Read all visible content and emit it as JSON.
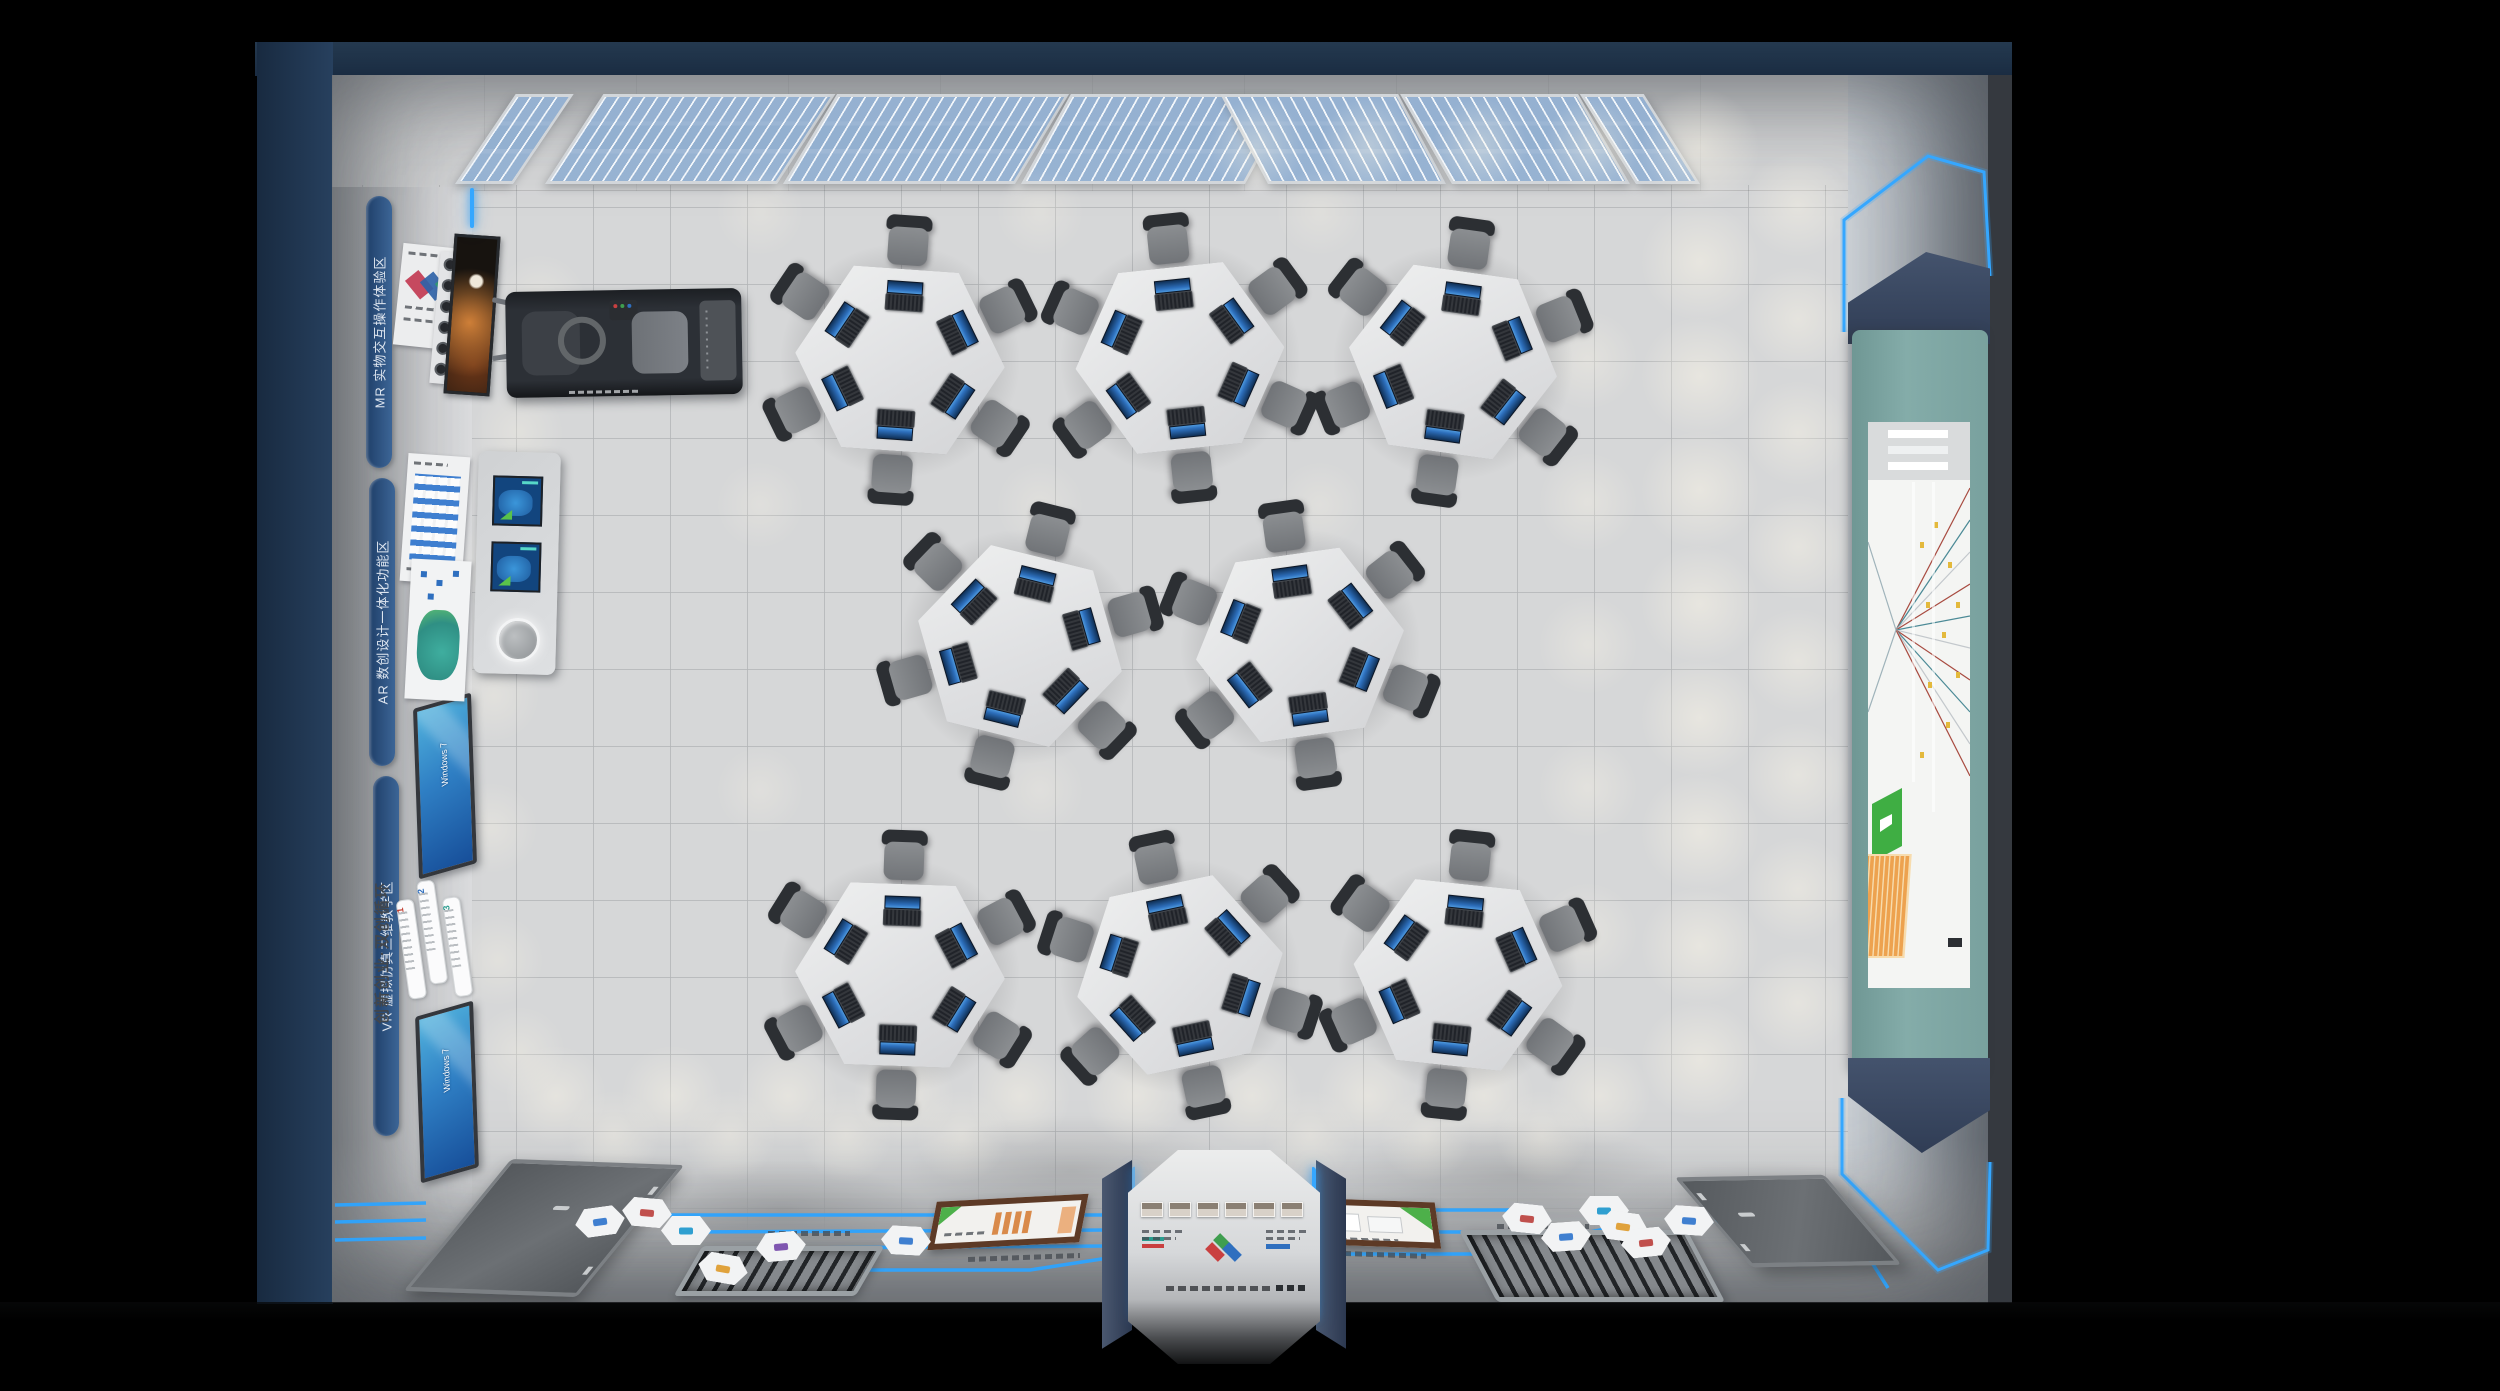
{
  "colors": {
    "outer_frame": "#1b2e46",
    "floor": "#d6d7d8",
    "accent_led": "#35a7ff",
    "zone_strip_blue": "#2f4f7d",
    "screen_frame_teal": "#79a19e",
    "poster_frame_brown": "#5d3a26",
    "windows_screen_blue": "#2f7fc4"
  },
  "left_wall": {
    "zone_labels": [
      {
        "label": "MR 实物交互操作体验区"
      },
      {
        "label": "AR 数创设计一体化功能区"
      },
      {
        "label": "VR 虚拟仿真三维教学区"
      }
    ],
    "wall_title": "创新创业·双创循环",
    "flow_steps": [
      {
        "num": "1"
      },
      {
        "num": "2"
      },
      {
        "num": "3"
      }
    ],
    "monitors": [
      {
        "os_label": "Windows 7"
      },
      {
        "os_label": "Windows 7"
      }
    ]
  },
  "workstations": {
    "table_count": 8,
    "chairs_per_table": 6,
    "laptops_per_table": 6
  },
  "bottom_wall": {
    "doors": 2,
    "floor_vents": 2,
    "framed_posters": 2,
    "hex_floor_plates": 12,
    "portrait_photos_on_pylon": 6
  },
  "skylights": {
    "window_banks": 2
  }
}
